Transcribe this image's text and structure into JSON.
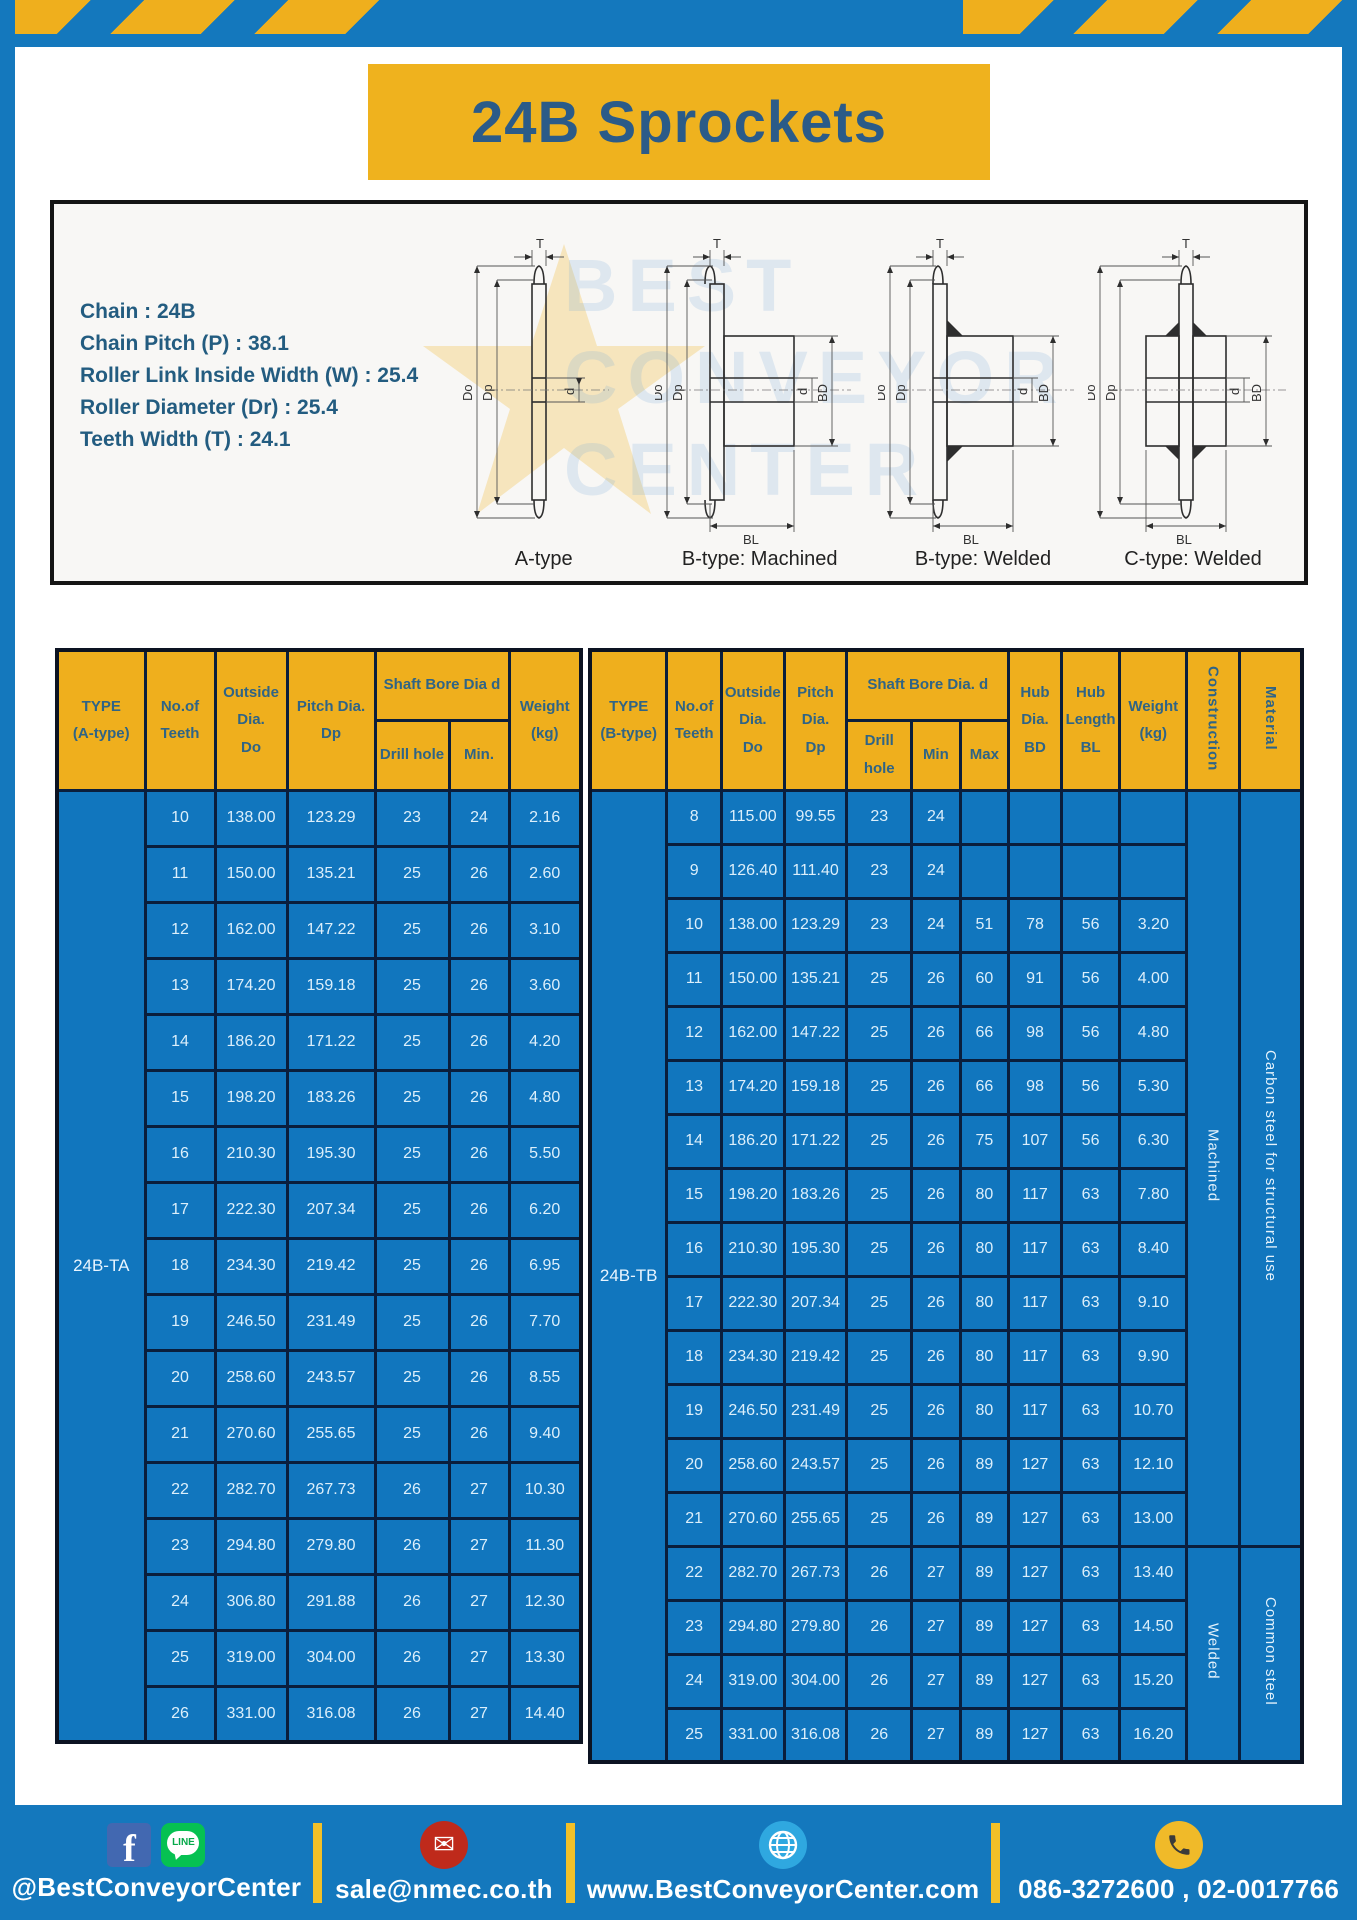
{
  "title": "24B Sprockets",
  "specs": [
    "Chain : 24B",
    "Chain Pitch (P) : 38.1",
    "Roller Link Inside Width (W) : 25.4",
    "Roller Diameter (Dr) : 25.4",
    "Teeth Width (T) : 24.1"
  ],
  "watermark": "BEST\nCONVEYOR\nCENTER",
  "dim_labels": {
    "t": "T",
    "do": "Do",
    "dp": "Dp",
    "d": "d",
    "bd": "BD",
    "bl": "BL"
  },
  "diagrams": [
    {
      "label": "A-type"
    },
    {
      "label": "B-type: Machined"
    },
    {
      "label": "B-type: Welded"
    },
    {
      "label": "C-type: Welded"
    }
  ],
  "table_a": {
    "type_label": "24B-TA",
    "headers": {
      "type": "TYPE\n(A-type)",
      "teeth": "No.of\nTeeth",
      "outside": "Outside\nDia.\nDo",
      "pitch": "Pitch Dia.\nDp",
      "shaft": "Shaft Bore Dia d",
      "drill": "Drill hole",
      "min": "Min.",
      "weight": "Weight\n(kg)"
    },
    "rows": [
      [
        "10",
        "138.00",
        "123.29",
        "23",
        "24",
        "2.16"
      ],
      [
        "11",
        "150.00",
        "135.21",
        "25",
        "26",
        "2.60"
      ],
      [
        "12",
        "162.00",
        "147.22",
        "25",
        "26",
        "3.10"
      ],
      [
        "13",
        "174.20",
        "159.18",
        "25",
        "26",
        "3.60"
      ],
      [
        "14",
        "186.20",
        "171.22",
        "25",
        "26",
        "4.20"
      ],
      [
        "15",
        "198.20",
        "183.26",
        "25",
        "26",
        "4.80"
      ],
      [
        "16",
        "210.30",
        "195.30",
        "25",
        "26",
        "5.50"
      ],
      [
        "17",
        "222.30",
        "207.34",
        "25",
        "26",
        "6.20"
      ],
      [
        "18",
        "234.30",
        "219.42",
        "25",
        "26",
        "6.95"
      ],
      [
        "19",
        "246.50",
        "231.49",
        "25",
        "26",
        "7.70"
      ],
      [
        "20",
        "258.60",
        "243.57",
        "25",
        "26",
        "8.55"
      ],
      [
        "21",
        "270.60",
        "255.65",
        "25",
        "26",
        "9.40"
      ],
      [
        "22",
        "282.70",
        "267.73",
        "26",
        "27",
        "10.30"
      ],
      [
        "23",
        "294.80",
        "279.80",
        "26",
        "27",
        "11.30"
      ],
      [
        "24",
        "306.80",
        "291.88",
        "26",
        "27",
        "12.30"
      ],
      [
        "25",
        "319.00",
        "304.00",
        "26",
        "27",
        "13.30"
      ],
      [
        "26",
        "331.00",
        "316.08",
        "26",
        "27",
        "14.40"
      ]
    ]
  },
  "table_b": {
    "type_label": "24B-TB",
    "headers": {
      "type": "TYPE\n(B-type)",
      "teeth": "No.of\nTeeth",
      "outside": "Outside\nDia.\nDo",
      "pitch": "Pitch\nDia.\nDp",
      "shaft": "Shaft Bore Dia. d",
      "drill": "Drill hole",
      "min": "Min",
      "max": "Max",
      "hub_dia": "Hub\nDia.\nBD",
      "hub_len": "Hub\nLength\nBL",
      "weight": "Weight\n(kg)",
      "construction": "Construction",
      "material": "Material"
    },
    "rows": [
      [
        "8",
        "115.00",
        "99.55",
        "23",
        "24",
        "",
        "",
        "",
        ""
      ],
      [
        "9",
        "126.40",
        "111.40",
        "23",
        "24",
        "",
        "",
        "",
        ""
      ],
      [
        "10",
        "138.00",
        "123.29",
        "23",
        "24",
        "51",
        "78",
        "56",
        "3.20"
      ],
      [
        "11",
        "150.00",
        "135.21",
        "25",
        "26",
        "60",
        "91",
        "56",
        "4.00"
      ],
      [
        "12",
        "162.00",
        "147.22",
        "25",
        "26",
        "66",
        "98",
        "56",
        "4.80"
      ],
      [
        "13",
        "174.20",
        "159.18",
        "25",
        "26",
        "66",
        "98",
        "56",
        "5.30"
      ],
      [
        "14",
        "186.20",
        "171.22",
        "25",
        "26",
        "75",
        "107",
        "56",
        "6.30"
      ],
      [
        "15",
        "198.20",
        "183.26",
        "25",
        "26",
        "80",
        "117",
        "63",
        "7.80"
      ],
      [
        "16",
        "210.30",
        "195.30",
        "25",
        "26",
        "80",
        "117",
        "63",
        "8.40"
      ],
      [
        "17",
        "222.30",
        "207.34",
        "25",
        "26",
        "80",
        "117",
        "63",
        "9.10"
      ],
      [
        "18",
        "234.30",
        "219.42",
        "25",
        "26",
        "80",
        "117",
        "63",
        "9.90"
      ],
      [
        "19",
        "246.50",
        "231.49",
        "25",
        "26",
        "80",
        "117",
        "63",
        "10.70"
      ],
      [
        "20",
        "258.60",
        "243.57",
        "25",
        "26",
        "89",
        "127",
        "63",
        "12.10"
      ],
      [
        "21",
        "270.60",
        "255.65",
        "25",
        "26",
        "89",
        "127",
        "63",
        "13.00"
      ],
      [
        "22",
        "282.70",
        "267.73",
        "26",
        "27",
        "89",
        "127",
        "63",
        "13.40"
      ],
      [
        "23",
        "294.80",
        "279.80",
        "26",
        "27",
        "89",
        "127",
        "63",
        "14.50"
      ],
      [
        "24",
        "319.00",
        "304.00",
        "26",
        "27",
        "89",
        "127",
        "63",
        "15.20"
      ],
      [
        "25",
        "331.00",
        "316.08",
        "26",
        "27",
        "89",
        "127",
        "63",
        "16.20"
      ]
    ],
    "construction_spans": [
      {
        "label": "Machined",
        "rows": 14
      },
      {
        "label": "Welded",
        "rows": 4
      }
    ],
    "material_spans": [
      {
        "label": "Carbon steel for structural use",
        "rows": 14
      },
      {
        "label": "Common steel",
        "rows": 4
      }
    ]
  },
  "footer": {
    "social_handle": "@BestConveyorCenter",
    "email": "sale@nmec.co.th",
    "website": "www.BestConveyorCenter.com",
    "phone": "086-3272600 , 02-0017766",
    "facebook_letter": "f",
    "line_label": "LINE",
    "mail_glyph": "✉"
  },
  "colors": {
    "frame_blue": "#1478BD",
    "table_blue": "#1176BE",
    "header_gold": "#EFAF1D",
    "title_gold": "#EFB21E",
    "title_text": "#2B5B88",
    "divider_yellow": "#F2C028",
    "cell_border": "#0A1E3C"
  }
}
